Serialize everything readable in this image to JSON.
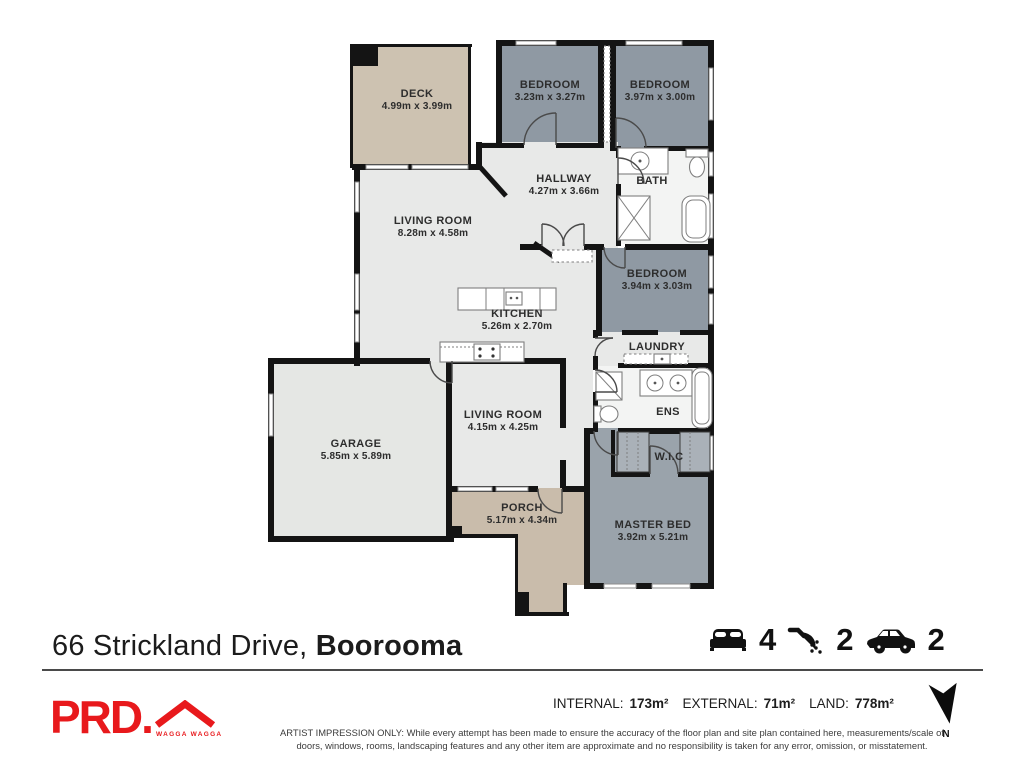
{
  "plan": {
    "rooms": [
      {
        "id": "deck",
        "name": "DECK",
        "dims": "4.99m x 3.99m"
      },
      {
        "id": "bedroom1",
        "name": "BEDROOM",
        "dims": "3.23m x 3.27m"
      },
      {
        "id": "bedroom2",
        "name": "BEDROOM",
        "dims": "3.97m x 3.00m"
      },
      {
        "id": "hallway",
        "name": "HALLWAY",
        "dims": "4.27m x 3.66m"
      },
      {
        "id": "bath",
        "name": "BATH",
        "dims": ""
      },
      {
        "id": "living1",
        "name": "LIVING ROOM",
        "dims": "8.28m x 4.58m"
      },
      {
        "id": "bedroom3",
        "name": "BEDROOM",
        "dims": "3.94m x 3.03m"
      },
      {
        "id": "kitchen",
        "name": "KITCHEN",
        "dims": "5.26m x 2.70m"
      },
      {
        "id": "laundry",
        "name": "LAUNDRY",
        "dims": ""
      },
      {
        "id": "ens",
        "name": "ENS",
        "dims": ""
      },
      {
        "id": "wic",
        "name": "W.I.C",
        "dims": ""
      },
      {
        "id": "garage",
        "name": "GARAGE",
        "dims": "5.85m x 5.89m"
      },
      {
        "id": "living2",
        "name": "LIVING ROOM",
        "dims": "4.15m x 4.25m"
      },
      {
        "id": "porch",
        "name": "PORCH",
        "dims": "5.17m x 4.34m"
      },
      {
        "id": "master",
        "name": "MASTER BED",
        "dims": "3.92m x 5.21m"
      }
    ]
  },
  "address": {
    "street": "66 Strickland Drive,",
    "suburb": "Boorooma"
  },
  "features": {
    "beds": "4",
    "showers": "2",
    "cars": "2"
  },
  "areas": {
    "internal_label": "INTERNAL:",
    "internal": "173m²",
    "external_label": "EXTERNAL:",
    "external": "71m²",
    "land_label": "LAND:",
    "land": "778m²"
  },
  "branding": {
    "logo": "PRD.",
    "location": "WAGGA WAGGA"
  },
  "compass": {
    "label": "N"
  },
  "disclaimer": {
    "line1": "ARTIST IMPRESSION ONLY: While every attempt has been made to ensure the accuracy of the floor plan and site plan contained here, measurements/scale of",
    "line2": "doors, windows, rooms, landscaping features and any other item are approximate and no responsibility is taken for any error, omission, or misstatement."
  },
  "colors": {
    "accent_red": "#e8191c",
    "wall": "#141414",
    "bedroom_fill": "#8f99a3",
    "master_fill": "#9aa3ab",
    "living_fill": "#e8e9e8",
    "garage_fill": "#e5e7e4",
    "wet_fill": "#f3f4f3",
    "deck_fill": "#cdc2b1",
    "porch_fill": "#c9bcab"
  }
}
